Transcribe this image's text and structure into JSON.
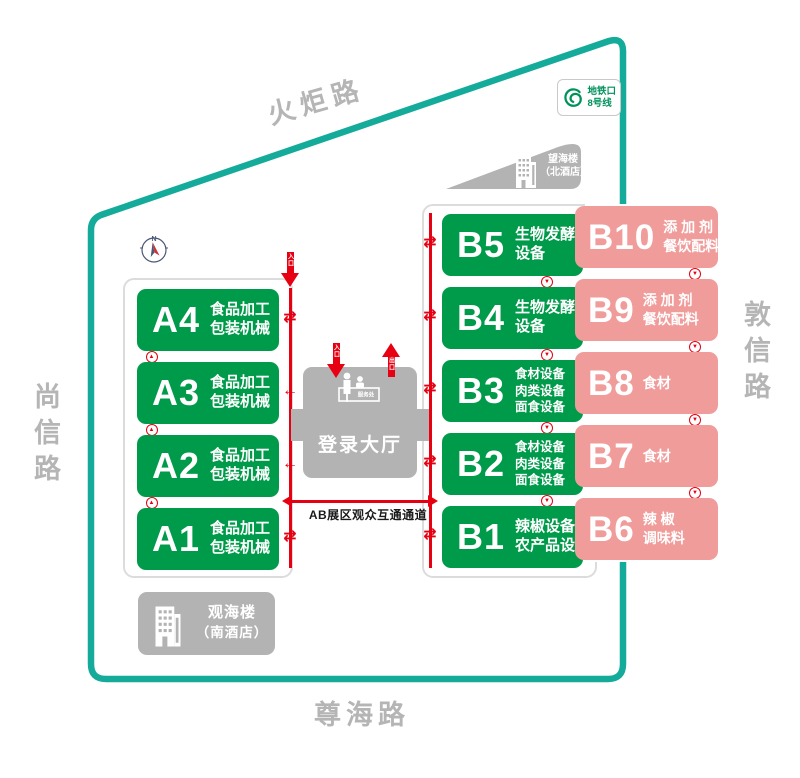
{
  "roads": {
    "top": "火炬路",
    "left": "尚信路",
    "right": "敦信路",
    "bottom": "尊海路"
  },
  "metro_badge": {
    "station": "地铁口",
    "line": "8号线"
  },
  "hotels": {
    "north": {
      "name": "望海楼",
      "subtitle": "（北酒店）"
    },
    "south": {
      "name": "观海楼",
      "subtitle": "（南酒店）"
    }
  },
  "login_hall": {
    "name": "登录大厅",
    "service_desk": "服务处",
    "entrance_label": "入口",
    "exit_label": "出口"
  },
  "zone_a_entrance_label": "入口",
  "corridor_label": "AB展区观众互通通道",
  "compass_label": "N",
  "halls": {
    "zone_a": [
      {
        "id": "A4",
        "desc": [
          "食品加工",
          "包装机械"
        ],
        "arrow": "both"
      },
      {
        "id": "A3",
        "desc": [
          "食品加工",
          "包装机械"
        ],
        "arrow": "left"
      },
      {
        "id": "A2",
        "desc": [
          "食品加工",
          "包装机械"
        ],
        "arrow": "left"
      },
      {
        "id": "A1",
        "desc": [
          "食品加工",
          "包装机械"
        ],
        "arrow": "both"
      }
    ],
    "zone_b_green": [
      {
        "id": "B5",
        "desc": [
          "生物发酵",
          "设备"
        ],
        "arrow": "both"
      },
      {
        "id": "B4",
        "desc": [
          "生物发酵",
          "设备"
        ],
        "arrow": "both"
      },
      {
        "id": "B3",
        "desc": [
          "食材设备",
          "肉类设备",
          "面食设备"
        ],
        "arrow": "both"
      },
      {
        "id": "B2",
        "desc": [
          "食材设备",
          "肉类设备",
          "面食设备"
        ],
        "arrow": "both"
      },
      {
        "id": "B1",
        "desc": [
          "辣椒设备",
          "农产品设备"
        ],
        "arrow": "both"
      }
    ],
    "zone_b_pink": [
      {
        "id": "B10",
        "desc": [
          "添 加 剂",
          "餐饮配料"
        ]
      },
      {
        "id": "B9",
        "desc": [
          "添 加 剂",
          "餐饮配料"
        ]
      },
      {
        "id": "B8",
        "desc": [
          "食材"
        ]
      },
      {
        "id": "B7",
        "desc": [
          "食材"
        ]
      },
      {
        "id": "B6",
        "desc": [
          "辣 椒",
          "调味料"
        ]
      }
    ]
  },
  "icons": {
    "gap_arrow_up": "▲",
    "gap_arrow_down": "▼",
    "two_way_arrow": "⇄",
    "left_arrow": "←"
  },
  "colors": {
    "green": "#009B4A",
    "pink": "#F09C9A",
    "teal": "#14AB9B",
    "red": "#E60012",
    "building_gray": "#B3B3B3",
    "road_text_gray": "#B5B5B5",
    "metro_green": "#00925B"
  }
}
